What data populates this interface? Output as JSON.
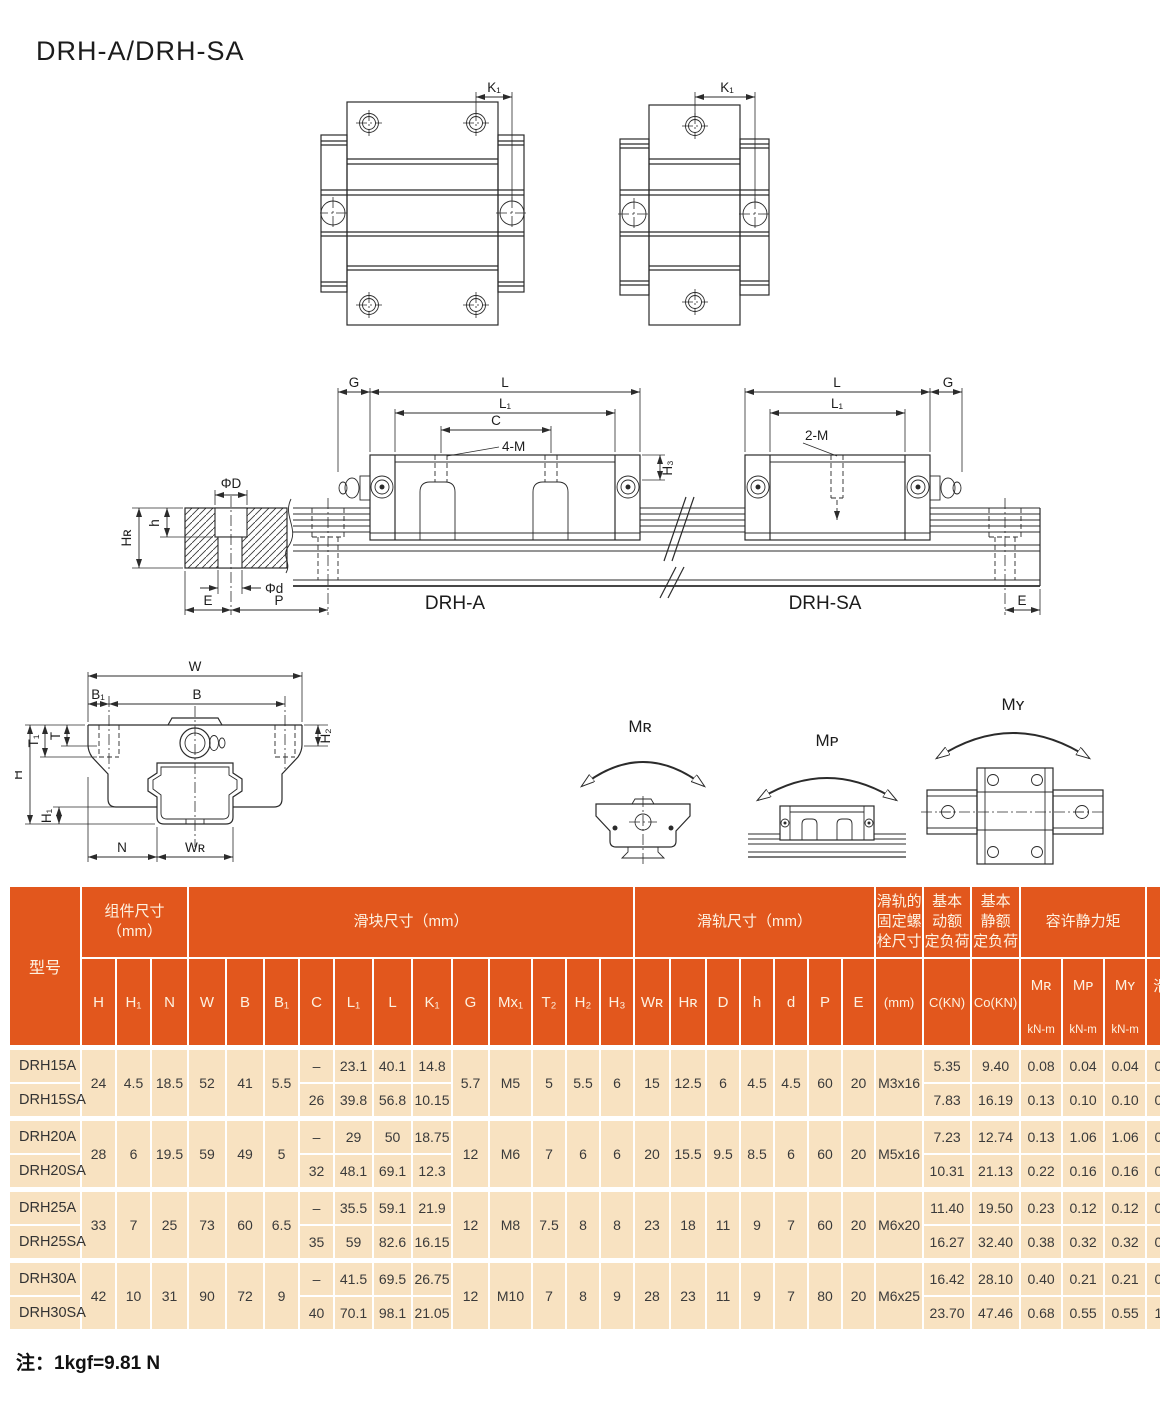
{
  "title": "DRH-A/DRH-SA",
  "note": "注：1kgf=9.81 N",
  "colors": {
    "header_bg": "#e2571d",
    "header_text": "#fdf2e1",
    "row_bg": "#f8e2c1",
    "grid": "#ffffff"
  },
  "drawings": {
    "top_view_a": {
      "k1": "K₁"
    },
    "top_view_sa": {
      "k1": "K₁"
    },
    "side_view": {
      "a": {
        "g": "G",
        "l": "L",
        "l1": "L₁",
        "c": "C",
        "m": "4-M",
        "h3": "H₃",
        "name": "DRH-A"
      },
      "sa": {
        "l": "L",
        "l1": "L₁",
        "m": "2-M",
        "g": "G",
        "e": "E",
        "name": "DRH-SA"
      },
      "rail": {
        "phi_D": "ΦD",
        "h": "h",
        "hr": "Hʀ",
        "phi_d": "Φd",
        "e": "E",
        "p": "P"
      }
    },
    "cross_section": {
      "w": "W",
      "b1": "B₁",
      "b": "B",
      "t1": "T₁",
      "t": "T",
      "h2": "H₂",
      "h": "H",
      "h1": "H₁",
      "n": "N",
      "wr": "Wʀ"
    },
    "moments": {
      "mr": "Mʀ",
      "mp": "Mᴘ",
      "my": "Mʏ"
    }
  },
  "table": {
    "model_header": "型号",
    "groups": [
      {
        "lines": [
          "组件尺寸",
          "（mm）"
        ],
        "span": 3
      },
      {
        "lines": [
          "滑块尺寸（mm）"
        ],
        "span": 12
      },
      {
        "lines": [
          "滑轨尺寸（mm）"
        ],
        "span": 7
      },
      {
        "lines": [
          "滑轨的",
          "固定螺",
          "栓尺寸"
        ],
        "span": 1
      },
      {
        "lines": [
          "基本",
          "动额",
          "定负荷"
        ],
        "span": 1
      },
      {
        "lines": [
          "基本",
          "静额",
          "定负荷"
        ],
        "span": 1
      },
      {
        "lines": [
          "容许静力矩"
        ],
        "span": 3
      },
      {
        "lines": [
          "重量"
        ],
        "span": 2
      }
    ],
    "columns": [
      {
        "top": "H"
      },
      {
        "top": "H₁"
      },
      {
        "top": "N"
      },
      {
        "top": "W"
      },
      {
        "top": "B"
      },
      {
        "top": "B₁"
      },
      {
        "top": "C"
      },
      {
        "top": "L₁"
      },
      {
        "top": "L"
      },
      {
        "top": "K₁"
      },
      {
        "top": "G"
      },
      {
        "top": "Mx₁"
      },
      {
        "top": "T₂"
      },
      {
        "top": "H₂"
      },
      {
        "top": "H₃"
      },
      {
        "top": "Wʀ"
      },
      {
        "top": "Hʀ"
      },
      {
        "top": "D"
      },
      {
        "top": "h"
      },
      {
        "top": "d"
      },
      {
        "top": "P"
      },
      {
        "top": "E"
      },
      {
        "mid": "(mm)"
      },
      {
        "mid": "C(KN)"
      },
      {
        "mid": "Co(KN)"
      },
      {
        "top": "Mʀ",
        "bottom": "kN-m"
      },
      {
        "top": "Mᴘ",
        "bottom": "kN-m"
      },
      {
        "top": "Mʏ",
        "bottom": "kN-m"
      },
      {
        "top": "滑块",
        "bottom": "kg"
      },
      {
        "top": "滑轨",
        "bottom": "kg/m"
      }
    ],
    "col_widths": [
      70,
      33,
      33,
      35,
      36,
      36,
      33,
      33,
      37,
      37,
      38,
      35,
      41,
      32,
      32,
      32,
      34,
      34,
      32,
      32,
      32,
      32,
      31,
      46,
      46,
      47,
      40,
      40,
      40,
      42,
      43
    ],
    "groups_data": [
      {
        "rows": [
          {
            "model": "DRH15A",
            "cl": [
              "–",
              "23.1",
              "40.1",
              "14.8"
            ],
            "cr": [
              "5.35",
              "9.40",
              "0.08",
              "0.04",
              "0.04",
              "0.12"
            ]
          },
          {
            "model": "DRH15SA",
            "cl": [
              "26",
              "39.8",
              "56.8",
              "10.15"
            ],
            "cr": [
              "7.83",
              "16.19",
              "0.13",
              "0.10",
              "0.10",
              "0.21"
            ]
          }
        ],
        "shared_left": [
          "24",
          "4.5",
          "18.5",
          "52",
          "41",
          "5.5"
        ],
        "shared_mid": [
          "5.7",
          "M5",
          "5",
          "5.5",
          "6",
          "15",
          "12.5",
          "6",
          "4.5",
          "4.5",
          "60",
          "20",
          "M3x16"
        ],
        "rail_weight": "1.25"
      },
      {
        "rows": [
          {
            "model": "DRH20A",
            "cl": [
              "–",
              "29",
              "50",
              "18.75"
            ],
            "cr": [
              "7.23",
              "12.74",
              "0.13",
              "1.06",
              "1.06",
              "0.19"
            ]
          },
          {
            "model": "DRH20SA",
            "cl": [
              "32",
              "48.1",
              "69.1",
              "12.3"
            ],
            "cr": [
              "10.31",
              "21.13",
              "0.22",
              "0.16",
              "0.16",
              "0.32"
            ]
          }
        ],
        "shared_left": [
          "28",
          "6",
          "19.5",
          "59",
          "49",
          "5"
        ],
        "shared_mid": [
          "12",
          "M6",
          "7",
          "6",
          "6",
          "20",
          "15.5",
          "9.5",
          "8.5",
          "6",
          "60",
          "20",
          "M5x16"
        ],
        "rail_weight": "2.08"
      },
      {
        "rows": [
          {
            "model": "DRH25A",
            "cl": [
              "–",
              "35.5",
              "59.1",
              "21.9"
            ],
            "cr": [
              "11.40",
              "19.50",
              "0.23",
              "0.12",
              "0.12",
              "0.35"
            ]
          },
          {
            "model": "DRH25SA",
            "cl": [
              "35",
              "59",
              "82.6",
              "16.15"
            ],
            "cr": [
              "16.27",
              "32.40",
              "0.38",
              "0.32",
              "0.32",
              "0.59"
            ]
          }
        ],
        "shared_left": [
          "33",
          "7",
          "25",
          "73",
          "60",
          "6.5"
        ],
        "shared_mid": [
          "12",
          "M8",
          "7.5",
          "8",
          "8",
          "23",
          "18",
          "11",
          "9",
          "7",
          "60",
          "20",
          "M6x20"
        ],
        "rail_weight": "2.67"
      },
      {
        "rows": [
          {
            "model": "DRH30A",
            "cl": [
              "–",
              "41.5",
              "69.5",
              "26.75"
            ],
            "cr": [
              "16.42",
              "28.10",
              "0.40",
              "0.21",
              "0.21",
              "0.62"
            ]
          },
          {
            "model": "DRH30SA",
            "cl": [
              "40",
              "70.1",
              "98.1",
              "21.05"
            ],
            "cr": [
              "23.70",
              "47.46",
              "0.68",
              "0.55",
              "0.55",
              "1.04"
            ]
          }
        ],
        "shared_left": [
          "42",
          "10",
          "31",
          "90",
          "72",
          "9"
        ],
        "shared_mid": [
          "12",
          "M10",
          "7",
          "8",
          "9",
          "28",
          "23",
          "11",
          "9",
          "7",
          "80",
          "20",
          "M6x25"
        ],
        "rail_weight": "4.35"
      }
    ]
  }
}
